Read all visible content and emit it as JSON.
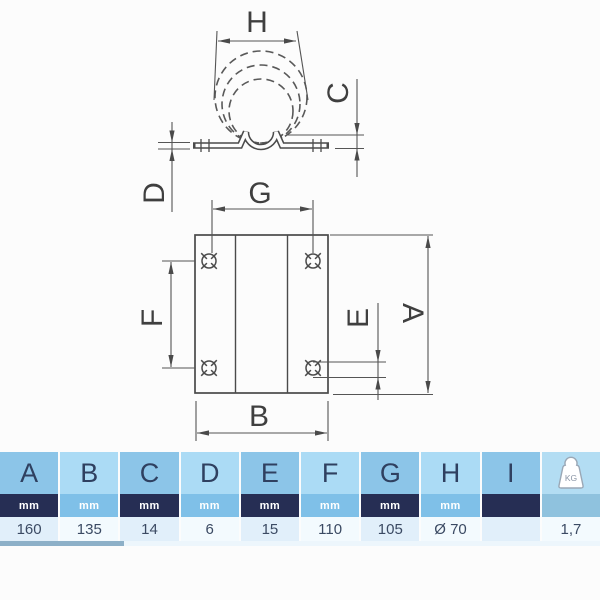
{
  "drawing": {
    "labels": {
      "H": "H",
      "C": "C",
      "D": "D",
      "G": "G",
      "F": "F",
      "E": "E",
      "A": "A",
      "B": "B"
    }
  },
  "table": {
    "kg_label": "KG",
    "columns": [
      {
        "letter": "A",
        "unit": "mm",
        "value": "160"
      },
      {
        "letter": "B",
        "unit": "mm",
        "value": "135"
      },
      {
        "letter": "C",
        "unit": "mm",
        "value": "14"
      },
      {
        "letter": "D",
        "unit": "mm",
        "value": "6"
      },
      {
        "letter": "E",
        "unit": "mm",
        "value": "15"
      },
      {
        "letter": "F",
        "unit": "mm",
        "value": "110"
      },
      {
        "letter": "G",
        "unit": "mm",
        "value": "105"
      },
      {
        "letter": "H",
        "unit": "mm",
        "value": "Ø 70"
      },
      {
        "letter": "I",
        "unit": "",
        "value": ""
      },
      {
        "letter": "",
        "unit": "",
        "value": "1,7"
      }
    ]
  },
  "colors": {
    "header_dark": "#8cc5e8",
    "header_light": "#abdbf5",
    "unit_navy": "#262e54",
    "unit_blue": "#7fc0e8",
    "unit_neutral": "#8fc2de",
    "value_tint": "#e1effa",
    "value_light": "#f3fafe",
    "scrollbar_thumb": "#8db0c8",
    "line_color": "#4a4a4a"
  }
}
